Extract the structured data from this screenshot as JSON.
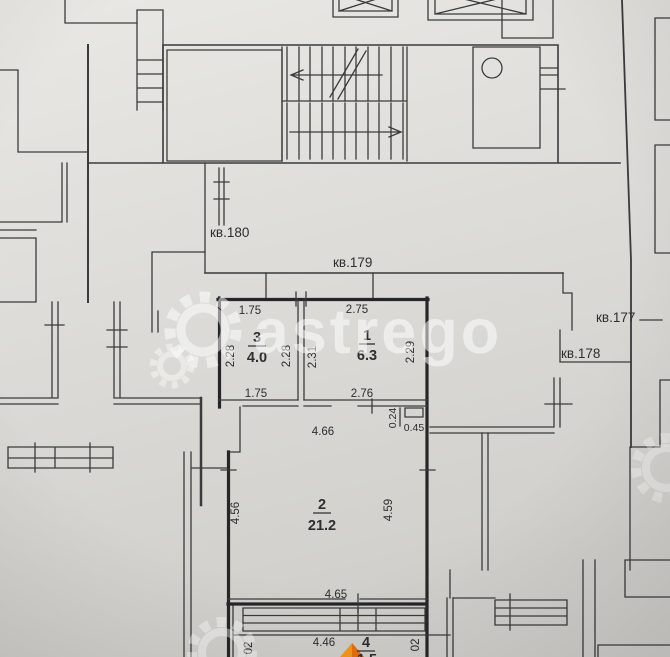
{
  "plan": {
    "watermark": "astrego",
    "apartment_labels": {
      "kv180": "кв.180",
      "kv179": "кв.179",
      "kv177": "кв.177",
      "kv178": "кв.178"
    },
    "rooms": {
      "room1": {
        "number": "1",
        "area": "6.3"
      },
      "room2": {
        "number": "2",
        "area": "21.2"
      },
      "room3": {
        "number": "3",
        "area": "4.0"
      },
      "room4": {
        "number": "4",
        "area": "1.5"
      }
    },
    "dims": {
      "room3_top": "1.75",
      "room1_top": "2.75",
      "room3_left": "2.28",
      "room3_right": "2.28",
      "room1_left": "2.31",
      "room1_right": "2.29",
      "room3_bottom": "1.75",
      "room1_bottom": "2.76",
      "hall_width": "4.66",
      "niche_depth": "0.24",
      "niche_width": "0.45",
      "room2_left": "4.56",
      "room2_right": "4.59",
      "room2_bottom": "4.65",
      "balcony_width": "4.46",
      "balcony_side_left": "02",
      "balcony_side_right": "02"
    }
  }
}
